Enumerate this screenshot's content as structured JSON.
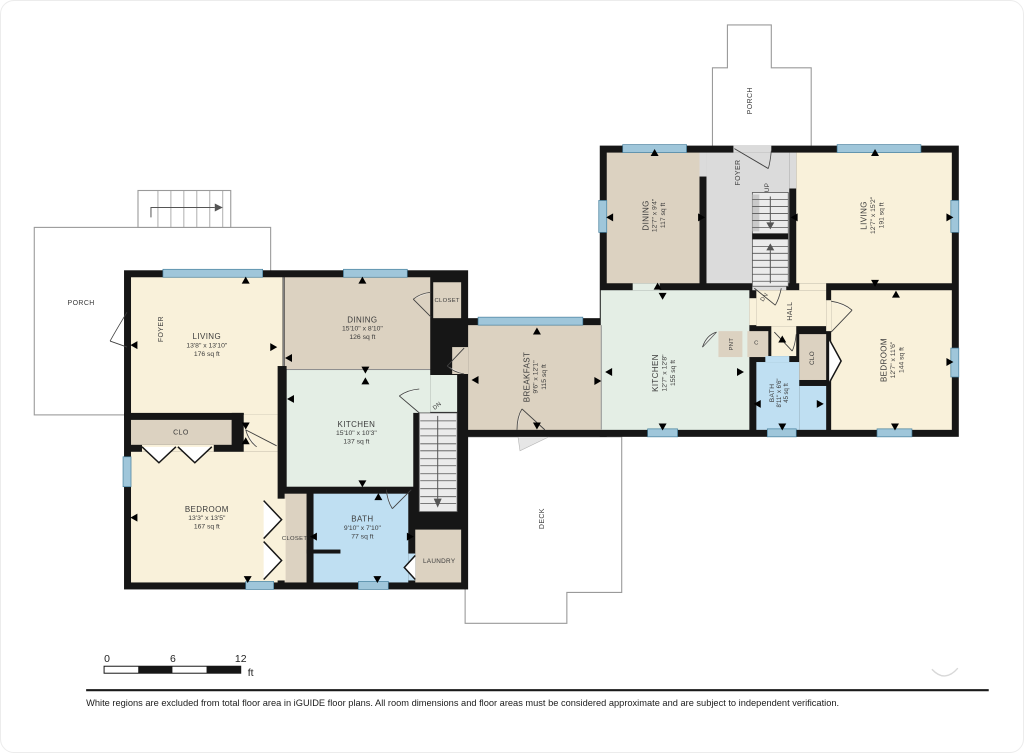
{
  "colors": {
    "wall": "#161616",
    "room_cream": "#f9f1da",
    "room_tan": "#dcd2c1",
    "room_green": "#e4eee5",
    "room_blue": "#bfdff2",
    "room_gray": "#dbdbdb",
    "window_blue": "#9fc6da",
    "exterior_outline": "#9a9a9a"
  },
  "rooms": {
    "living_left": {
      "name": "LIVING",
      "dim": "13'8\" x 13'10\"",
      "area": "176 sq ft"
    },
    "dining_left": {
      "name": "DINING",
      "dim": "15'10\" x 8'10\"",
      "area": "126 sq ft"
    },
    "kitchen_left": {
      "name": "KITCHEN",
      "dim": "15'10\" x 10'3\"",
      "area": "137 sq ft"
    },
    "bedroom_left": {
      "name": "BEDROOM",
      "dim": "13'3\" x 13'5\"",
      "area": "167 sq ft"
    },
    "bath_left": {
      "name": "BATH",
      "dim": "9'10\" x 7'10\"",
      "area": "77 sq ft"
    },
    "breakfast": {
      "name": "BREAKFAST",
      "dim": "9'6\" x 12'1\"",
      "area": "115 sq ft"
    },
    "kitchen_right": {
      "name": "KITCHEN",
      "dim": "12'7\" x 12'8\"",
      "area": "155 sq ft"
    },
    "dining_right": {
      "name": "DINING",
      "dim": "12'7\" x 9'4\"",
      "area": "117 sq ft"
    },
    "living_right": {
      "name": "LIVING",
      "dim": "12'7\" x 15'2\"",
      "area": "191 sq ft"
    },
    "bedroom_right": {
      "name": "BEDROOM",
      "dim": "12'7\" x 11'6\"",
      "area": "144 sq ft"
    },
    "bath_right": {
      "name": "BATH",
      "dim": "8'11\" x 6'6\"",
      "area": "45 sq ft"
    }
  },
  "labels": {
    "foyer_left": "FOYER",
    "clo_left": "CLO",
    "closet_top": "CLOSET",
    "closet_bedroom": "CLOSET",
    "laundry": "LAUNDRY",
    "dn_left": "DN",
    "porch_left": "PORCH",
    "deck": "DECK",
    "foyer_right": "FOYER",
    "up": "UP",
    "dn_right": "DN",
    "hall": "HALL",
    "pnt": "PNT",
    "c": "C",
    "clo_right": "CLO",
    "porch_right": "PORCH"
  },
  "scale_bar": {
    "tick_0": "0",
    "tick_6": "6",
    "tick_12": "12",
    "unit": "ft"
  },
  "footer": {
    "disclaimer": "White regions are excluded from total floor area in iGUIDE floor plans. All room dimensions and floor areas must be considered approximate and are subject to independent verification."
  }
}
